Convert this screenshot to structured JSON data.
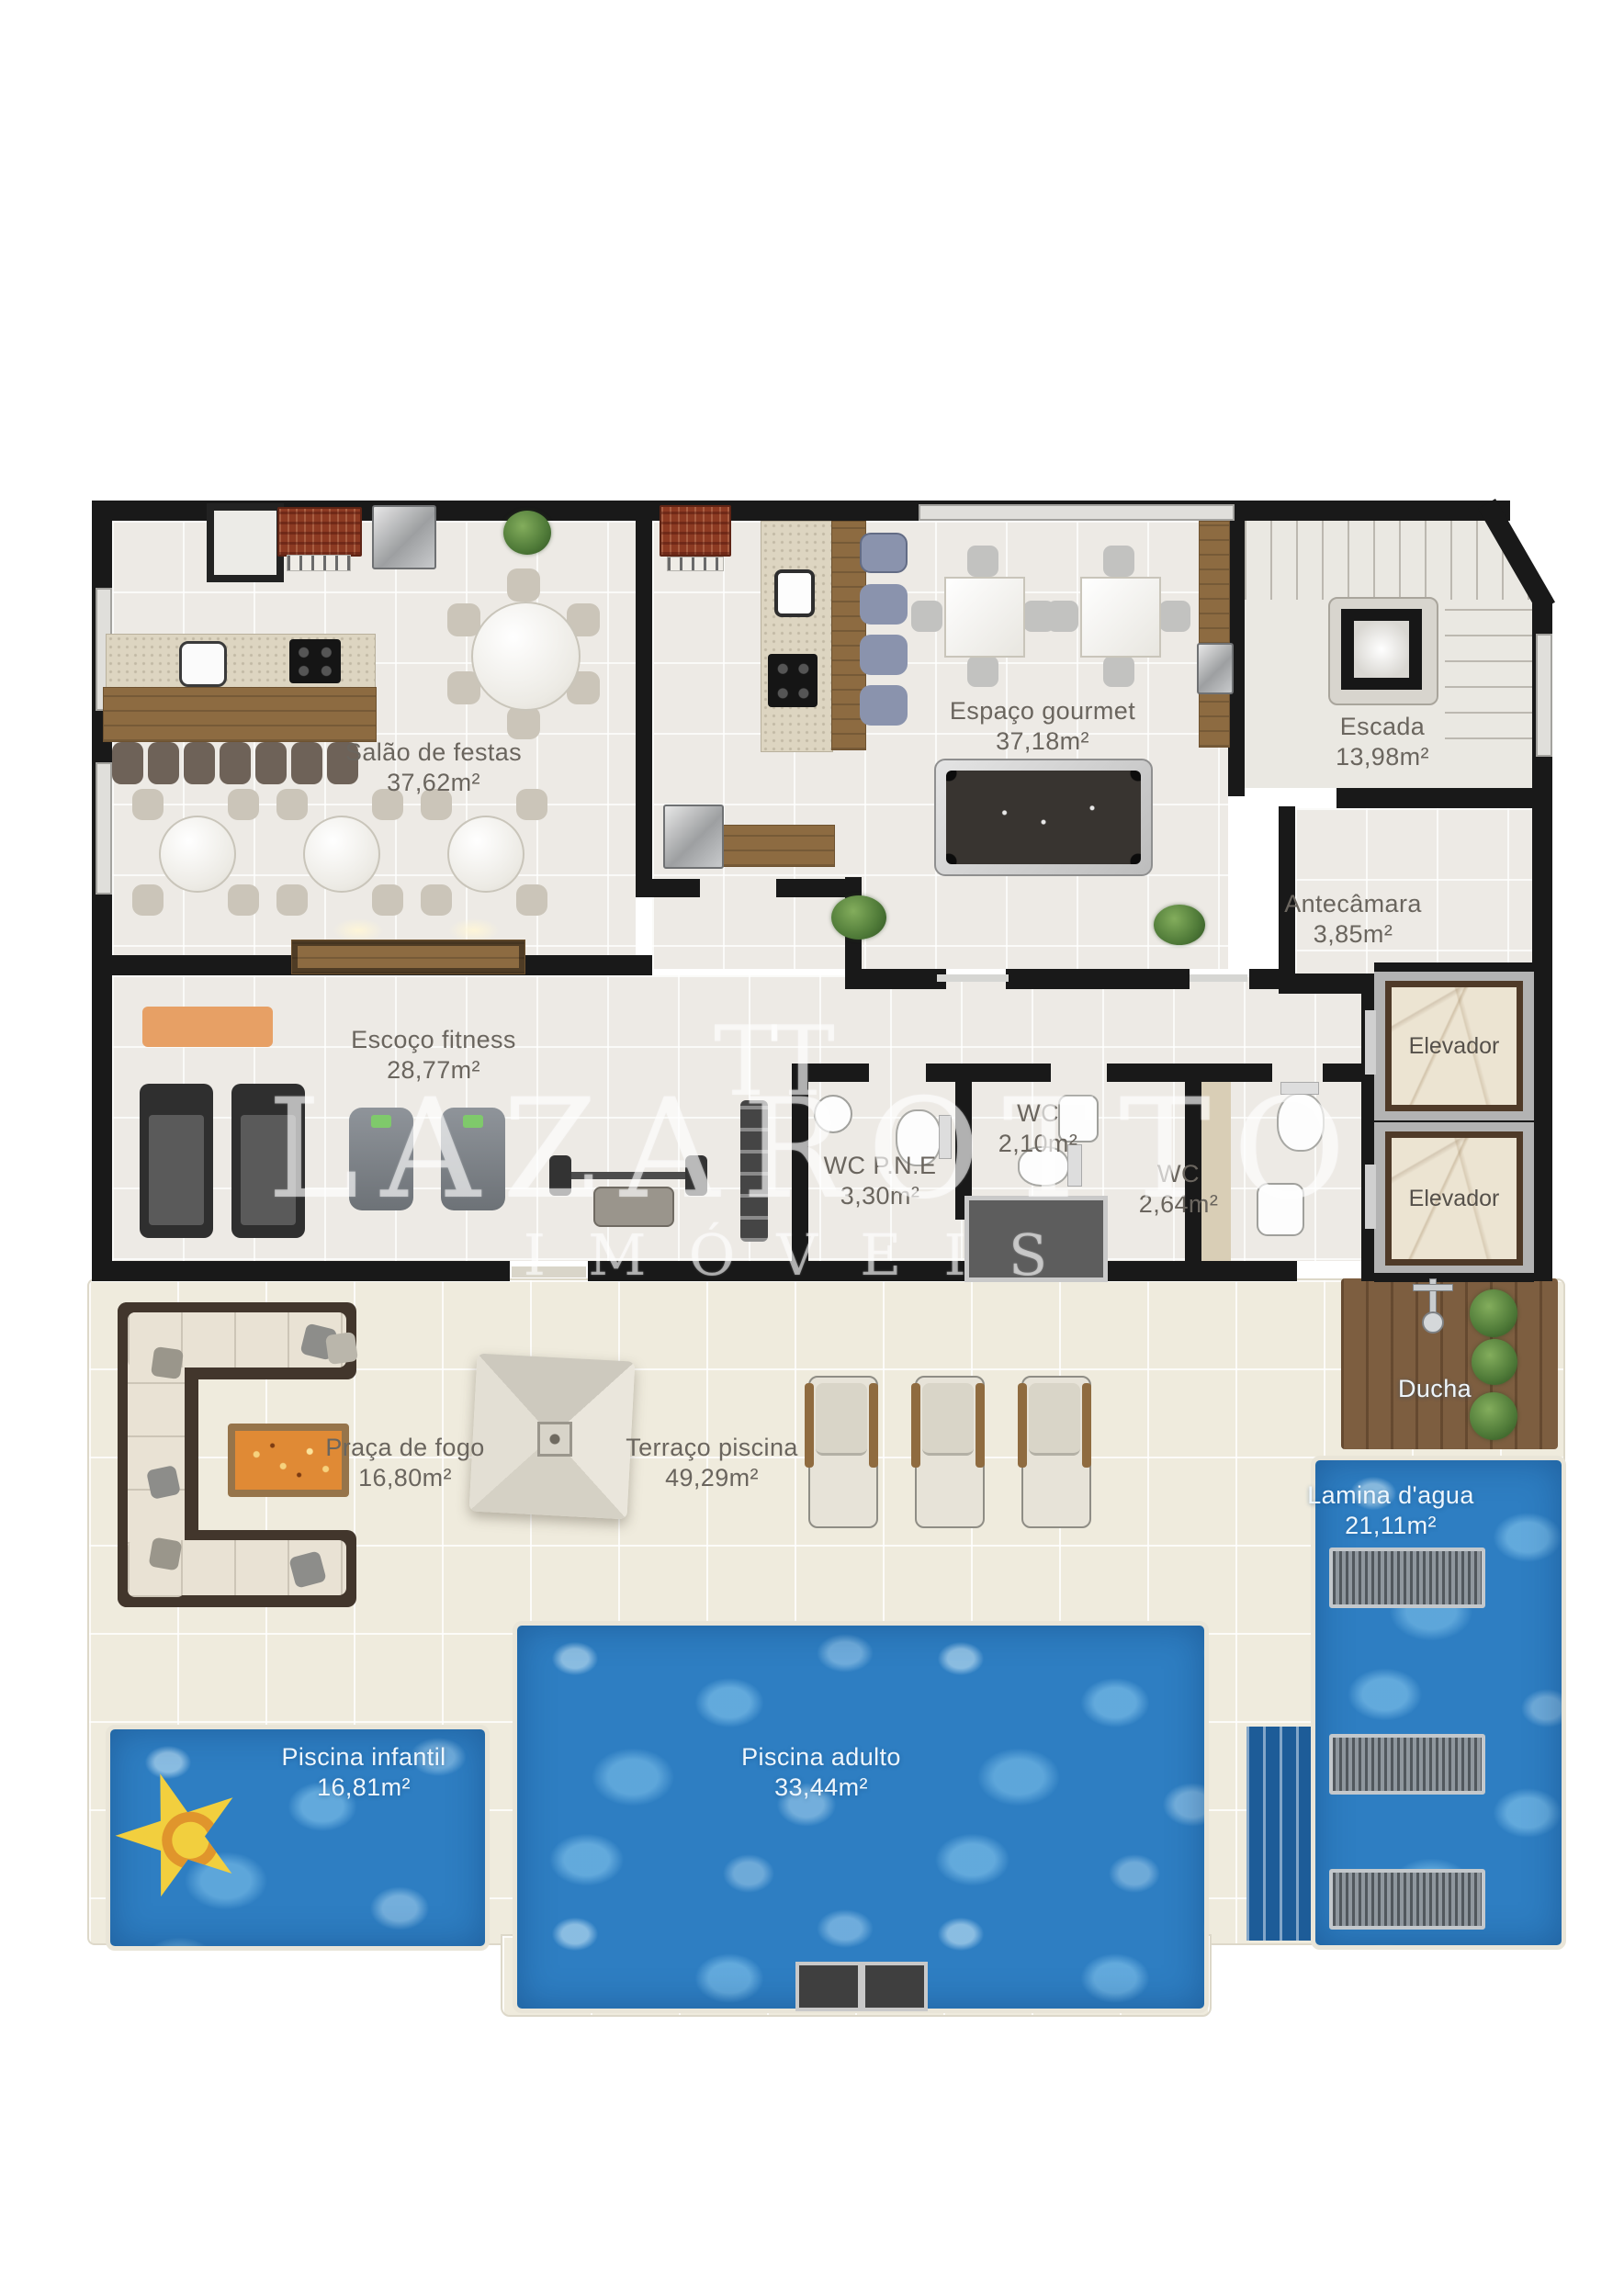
{
  "watermark": {
    "logo": "TT",
    "brand": "LAZAROTTO",
    "sub": "IMÓVEIS"
  },
  "labels": {
    "salao": {
      "name": "Salão de festas",
      "area": "37,62m²"
    },
    "gourmet": {
      "name": "Espaço gourmet",
      "area": "37,18m²"
    },
    "escada": {
      "name": "Escada",
      "area": "13,98m²"
    },
    "antecamara": {
      "name": "Antecâmara",
      "area": "3,85m²"
    },
    "elevador_1": {
      "name": "Elevador"
    },
    "elevador_2": {
      "name": "Elevador"
    },
    "fitness": {
      "name": "Escoço fitness",
      "area": "28,77m²"
    },
    "wc_pne": {
      "name": "WC P.N.E",
      "area": "3,30m²"
    },
    "wc_1": {
      "name": "WC",
      "area": "2,10m²"
    },
    "wc_2": {
      "name": "WC",
      "area": "2,64m²"
    },
    "ducha": {
      "name": "Ducha"
    },
    "praca_de_fogo": {
      "name": "Praça de fogo",
      "area": "16,80m²"
    },
    "terraco_piscina": {
      "name": "Terraço piscina",
      "area": "49,29m²"
    },
    "lamina_dagua": {
      "name": "Lamina d'agua",
      "area": "21,11m²"
    },
    "piscina_infantil": {
      "name": "Piscina infantil",
      "area": "16,81m²"
    },
    "piscina_adulto": {
      "name": "Piscina adulto",
      "area": "33,44m²"
    }
  },
  "colors": {
    "pool_water": "#2e7ec2",
    "deck_wood": "#7d5e40",
    "wall": "#191919",
    "terrace_tile": "#efebdd",
    "room_tile": "#edeae5",
    "fire": "#e08a35",
    "float_yellow": "#f2cf3e",
    "stool_blue": "#8a93ad"
  }
}
